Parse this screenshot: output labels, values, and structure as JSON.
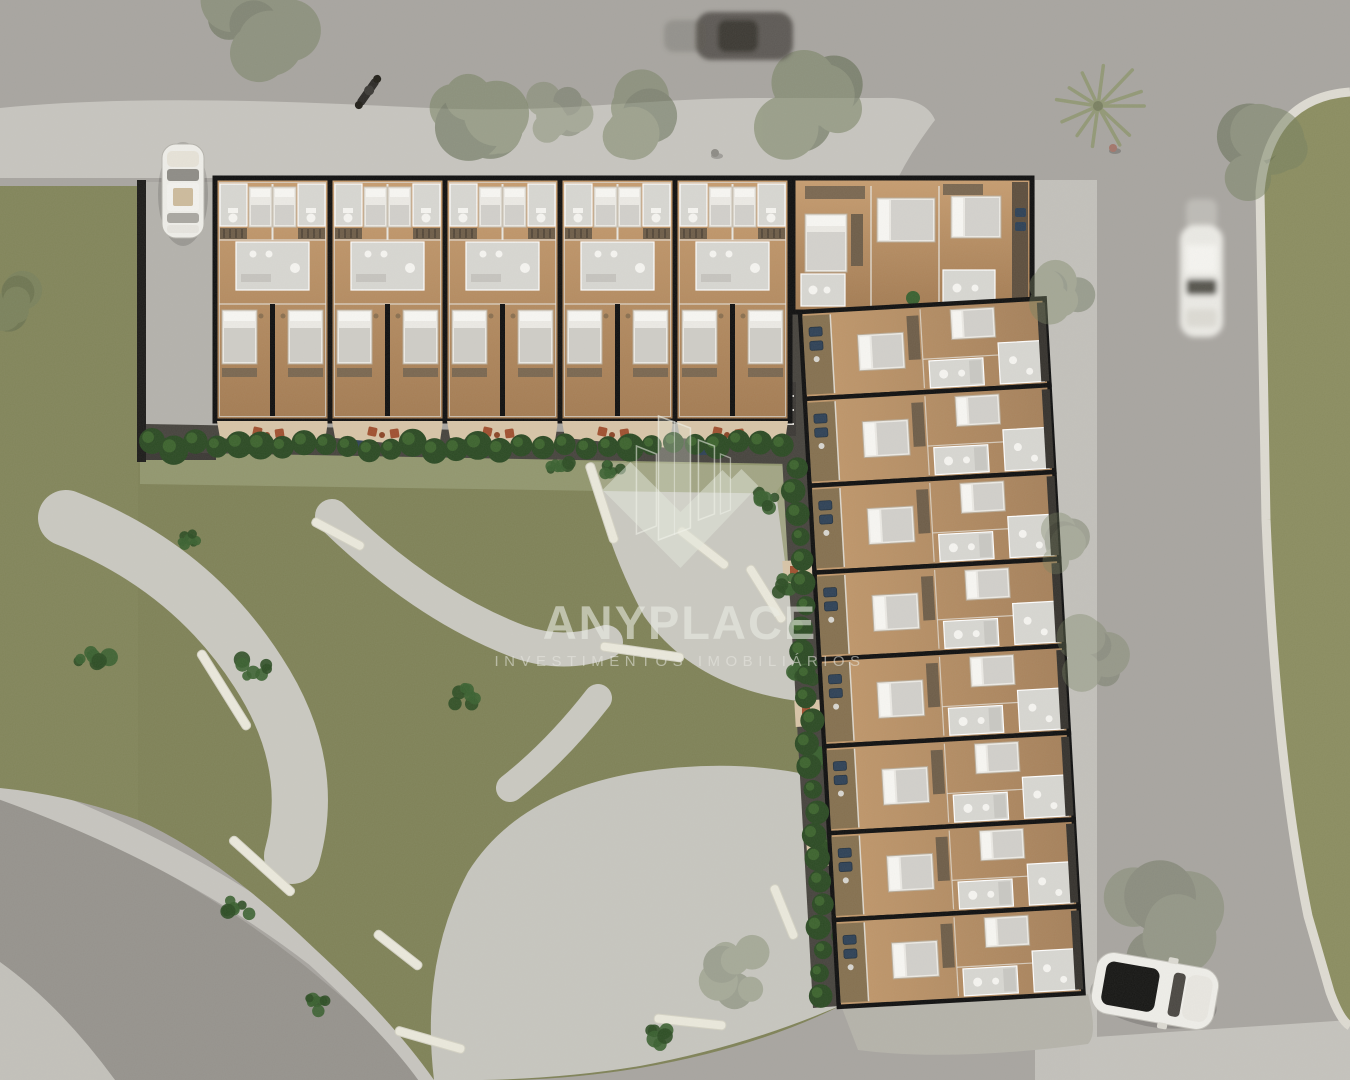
{
  "watermark": {
    "brand": "ANYPLACE",
    "tagline": "INVESTIMENTOS IMOBILIÁRIOS",
    "logo": "glass-towers-in-chevron-diamond"
  },
  "palette": {
    "asphalt": "#a8a5a0",
    "asphalt_dark": "#96938d",
    "sidewalk": "#c7c5bf",
    "curb": "#dedbd2",
    "lawn": "#878a5e",
    "lawn_bright": "#8b8d60",
    "garden_lawn": "#7f8257",
    "path": "#cac9c1",
    "grass_wisp": "#979c74",
    "wall": "#0f0f0f",
    "wood": "#bc9166",
    "wood_dark": "#9c7750",
    "wood_balcony": "#85704f",
    "tile": "#d8d7d2",
    "fixture": "#f6f5f1",
    "bed_white": "#eceae5",
    "bed_blanket": "#d2d0cb",
    "closet": "#6e5d48",
    "patio": "#d8c5a7",
    "chair_terracotta": "#a0502f",
    "chair_blue": "#2e4156",
    "deck": "#46433d",
    "court": "#b4b2ac",
    "hedge": "#2b4a23",
    "hedge_light": "#41692f",
    "shrub": "#3a6130",
    "bench": "#ebe9dc",
    "tree": "#76815f",
    "palm": "#8f966f",
    "car_white": "#efeee9",
    "car_dark": "#55524d"
  },
  "building": {
    "north_wing_unit_pairs": 5,
    "east_wing_unit_rows": 8,
    "corner_units": 1
  },
  "site": {
    "vehicles": [
      {
        "kind": "parked-car",
        "color_key": "car_white",
        "location": "top-left-parking"
      },
      {
        "kind": "moving-car",
        "color_key": "car_dark",
        "location": "top-road"
      },
      {
        "kind": "moving-car",
        "color_key": "car_white",
        "location": "right-road"
      },
      {
        "kind": "parked-suv",
        "color_key": "car_white",
        "location": "bottom-right-driveway"
      }
    ],
    "people": 2,
    "motorcycles": 1,
    "palm_trees": 1,
    "tree_canopies": 12,
    "garden_benches": 12,
    "shrub_clusters": 15,
    "hedge_rows": 2
  }
}
